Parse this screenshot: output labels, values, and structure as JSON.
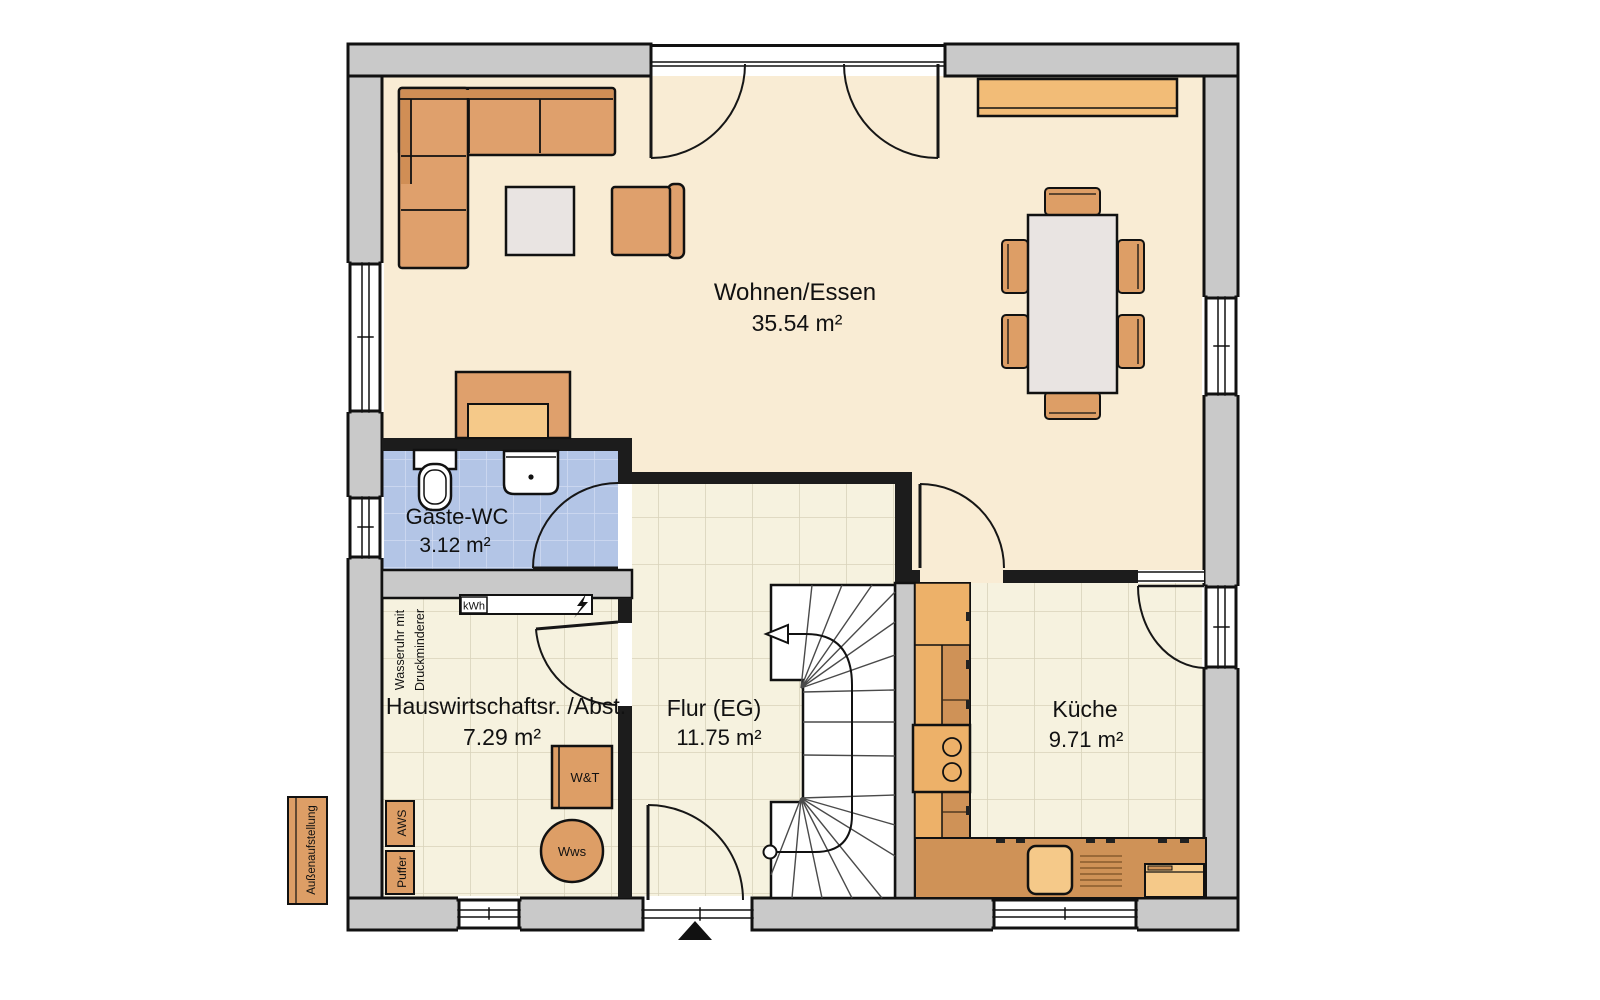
{
  "rooms": {
    "wohnen": {
      "name": "Wohnen/Essen",
      "area": "35.54 m²"
    },
    "gaeste_wc": {
      "name": "Gäste-WC",
      "area": "3.12 m²"
    },
    "hwr": {
      "name": "Hauswirtschaftsr. /Abst.",
      "area": "7.29 m²"
    },
    "flur": {
      "name": "Flur (EG)",
      "area": "11.75 m²"
    },
    "kueche": {
      "name": "Küche",
      "area": "9.71 m²"
    }
  },
  "equipment": {
    "kwh": "kWh",
    "wt": "W&T",
    "wws": "Wws",
    "aws": "AWS",
    "puffer": "Puffer",
    "aussenaufstellung": "Außenaufstellung",
    "wasseruhr_line1": "Wasseruhr mit",
    "wasseruhr_line2": "Druckminderer"
  },
  "colors": {
    "wall_gray": "#c9c9c9",
    "wall_dark": "#1c1c1c",
    "furniture_orange": "#dfa06c",
    "furniture_light": "#f2bc77",
    "counter_dark": "#cf9257",
    "floor_cream": "#f9ecd4",
    "tile_beige": "#f6f2df",
    "tile_blue": "#b3c5e6"
  }
}
